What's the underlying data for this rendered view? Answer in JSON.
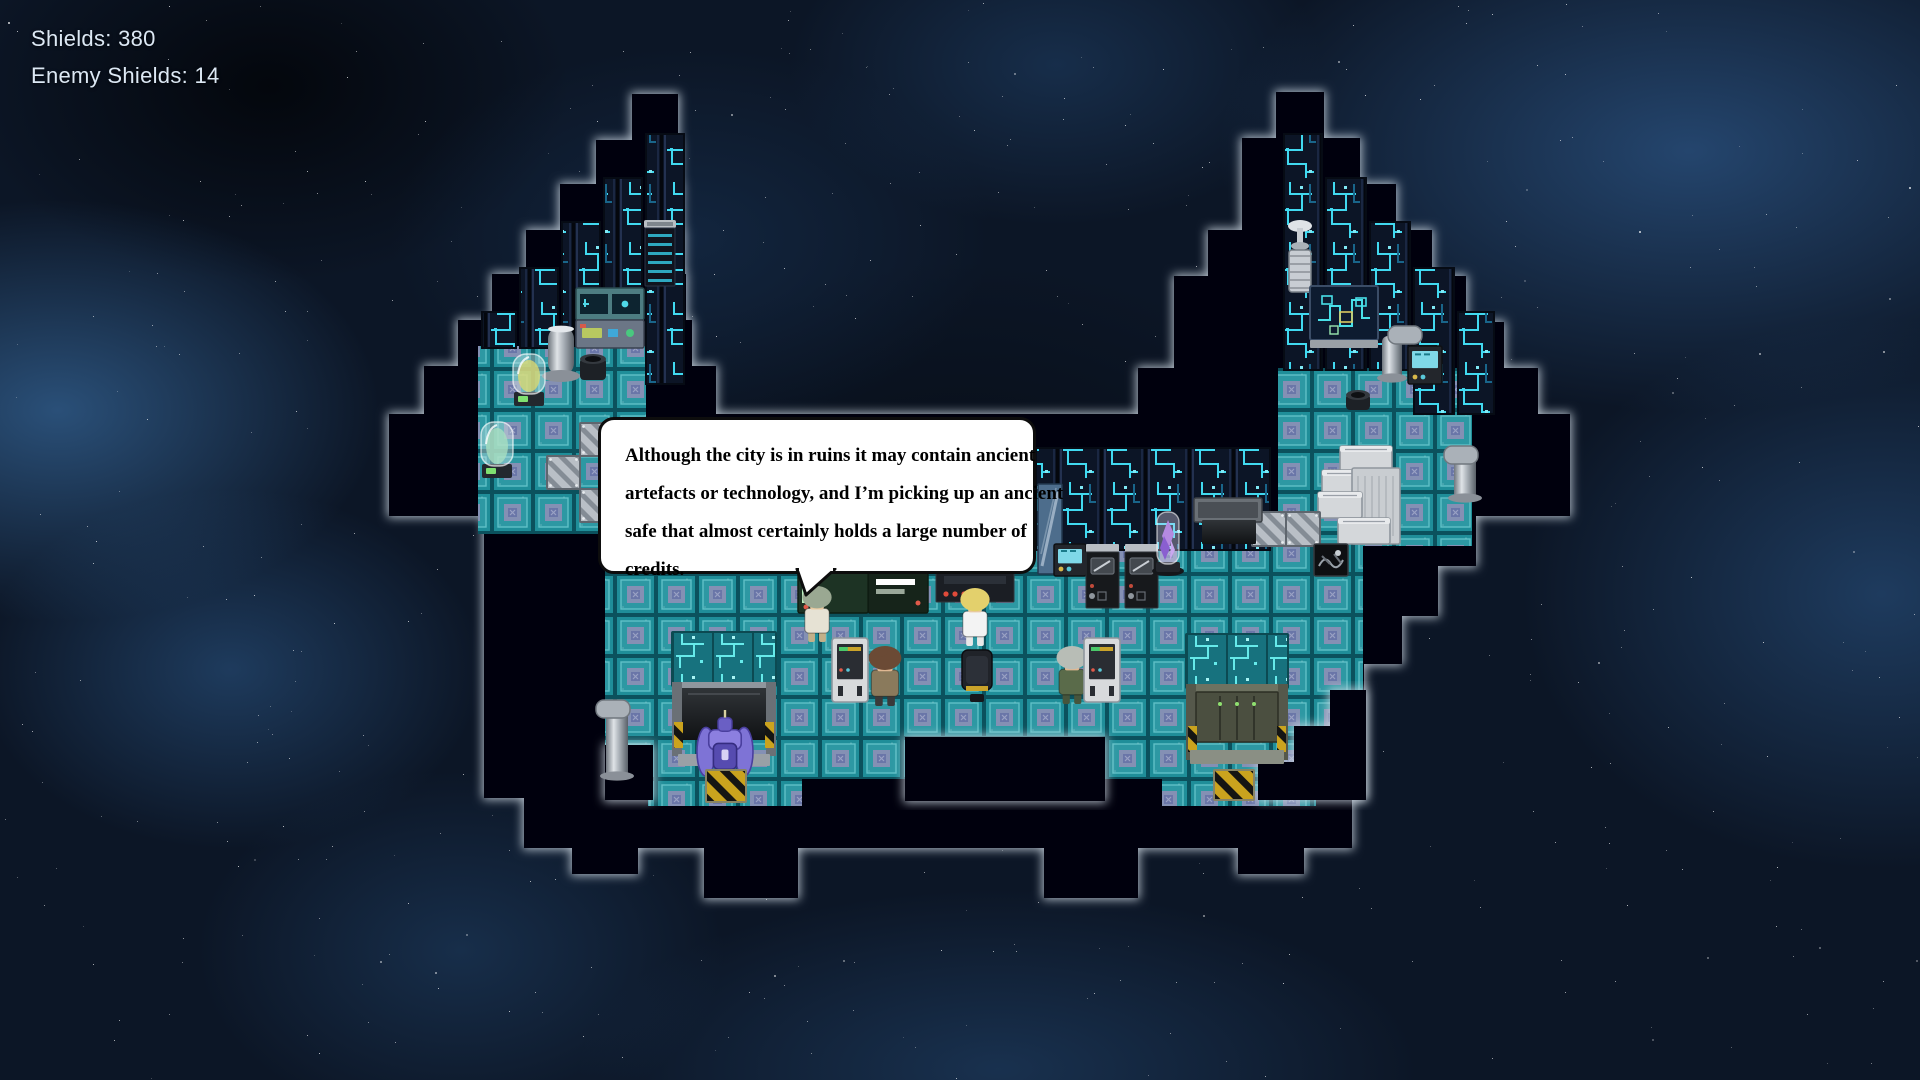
{
  "hud": {
    "shields": "Shields: 380",
    "enemy_shields": "Enemy Shields: 14"
  },
  "dialog": {
    "lines": [
      "Although the city is in ruins it may contain ancient",
      "artefacts or technology, and I’m picking up an ancient",
      "safe that almost certainly holds a large number of",
      "credits."
    ]
  },
  "palette": {
    "hud_text": "#dce8f4",
    "wall": "#040507",
    "wall_glow": "#cdd8e2",
    "floor_base": "#1f8e99",
    "floor_grid": "#0b515d",
    "floor_inner": "#2d98a3",
    "floor_emblem": "#8b90b5",
    "panel_bg": "#0c1526",
    "circuit_trace": "#41d9f0",
    "door_header": "#17727e",
    "hazard_yellow": "#caa31e",
    "silver": "#b9bfc6",
    "mech_purple": "#7e73d6"
  },
  "map": {
    "walls": [
      [
        632,
        94,
        46,
        48
      ],
      [
        596,
        140,
        84,
        46
      ],
      [
        560,
        184,
        122,
        48
      ],
      [
        526,
        230,
        158,
        46
      ],
      [
        492,
        274,
        194,
        48
      ],
      [
        458,
        320,
        234,
        48
      ],
      [
        424,
        366,
        292,
        50
      ],
      [
        1276,
        92,
        48,
        48
      ],
      [
        1242,
        138,
        118,
        48
      ],
      [
        1242,
        184,
        154,
        48
      ],
      [
        1208,
        230,
        224,
        48
      ],
      [
        1174,
        276,
        292,
        48
      ],
      [
        1174,
        322,
        330,
        46
      ],
      [
        1138,
        368,
        400,
        48
      ],
      [
        389,
        414,
        1181,
        102
      ],
      [
        484,
        514,
        880,
        284
      ],
      [
        1364,
        514,
        112,
        52
      ],
      [
        1364,
        566,
        74,
        50
      ],
      [
        1364,
        616,
        38,
        48
      ],
      [
        524,
        798,
        828,
        50
      ],
      [
        572,
        848,
        66,
        26
      ],
      [
        704,
        848,
        94,
        50
      ],
      [
        1044,
        848,
        94,
        50
      ],
      [
        1238,
        848,
        66,
        26
      ]
    ],
    "over_walls": [
      [
        905,
        737,
        200,
        64
      ],
      [
        1330,
        690,
        36,
        110
      ],
      [
        1294,
        726,
        40,
        74
      ],
      [
        1258,
        762,
        42,
        38
      ],
      [
        605,
        745,
        48,
        55
      ]
    ],
    "floors": [
      [
        478,
        346,
        168,
        188
      ],
      [
        605,
        530,
        758,
        209
      ],
      [
        605,
        739,
        302,
        40
      ],
      [
        1103,
        739,
        260,
        40
      ],
      [
        648,
        772,
        154,
        34
      ],
      [
        1162,
        772,
        154,
        34
      ],
      [
        1278,
        368,
        194,
        178
      ]
    ],
    "panels": [
      [
        646,
        134,
        38,
        250
      ],
      [
        604,
        178,
        38,
        114
      ],
      [
        562,
        222,
        38,
        124
      ],
      [
        520,
        268,
        38,
        80
      ],
      [
        482,
        312,
        34,
        36
      ],
      [
        1284,
        134,
        38,
        236
      ],
      [
        1326,
        178,
        40,
        192
      ],
      [
        1370,
        222,
        40,
        148
      ],
      [
        1414,
        268,
        40,
        146
      ],
      [
        1458,
        312,
        36,
        102
      ],
      [
        1036,
        448,
        234,
        102
      ]
    ],
    "entities": [
      {
        "name": "server-rack",
        "kind": "serverRack",
        "x": 644,
        "y": 220,
        "w": 32,
        "h": 66
      },
      {
        "name": "console-screens",
        "kind": "consoleTeal",
        "x": 576,
        "y": 288,
        "w": 68,
        "h": 32
      },
      {
        "name": "console-buttons",
        "kind": "consoleBtns",
        "x": 576,
        "y": 320,
        "w": 68,
        "h": 28
      },
      {
        "name": "pipe-left-tower",
        "kind": "pipeV",
        "x": 548,
        "y": 326,
        "w": 26,
        "h": 58
      },
      {
        "name": "pot-left-tower",
        "kind": "pot",
        "x": 578,
        "y": 352,
        "w": 30,
        "h": 30
      },
      {
        "name": "yellow-stasis-capsule",
        "kind": "capsule",
        "x": 512,
        "y": 348,
        "w": 34,
        "h": 60,
        "color": "#d9d873"
      },
      {
        "name": "green-stasis-capsule",
        "kind": "capsule",
        "x": 480,
        "y": 416,
        "w": 34,
        "h": 64,
        "color": "#a9dfc0"
      },
      {
        "name": "grate-tile-1",
        "kind": "grate",
        "x": 580,
        "y": 423,
        "w": 33,
        "h": 33
      },
      {
        "name": "grate-tile-2",
        "kind": "grate",
        "x": 547,
        "y": 456,
        "w": 33,
        "h": 33
      },
      {
        "name": "grate-tile-3",
        "kind": "grate",
        "x": 580,
        "y": 489,
        "w": 33,
        "h": 33
      },
      {
        "name": "trophy-fountain",
        "kind": "trophy",
        "x": 1282,
        "y": 220,
        "w": 36,
        "h": 74
      },
      {
        "name": "city-circuit-display",
        "kind": "circuitBoard",
        "x": 1310,
        "y": 286,
        "w": 68,
        "h": 62
      },
      {
        "name": "pipe-right-tower",
        "kind": "pipeElbowR",
        "x": 1382,
        "y": 326,
        "w": 44,
        "h": 56
      },
      {
        "name": "machine-right-tower",
        "kind": "screenDev",
        "x": 1408,
        "y": 346,
        "w": 34,
        "h": 38
      },
      {
        "name": "pot-right-tower",
        "kind": "pot",
        "x": 1344,
        "y": 388,
        "w": 28,
        "h": 24
      },
      {
        "name": "pipe-right-arm",
        "kind": "pipeElbowL",
        "x": 1444,
        "y": 446,
        "w": 40,
        "h": 56
      },
      {
        "name": "crate-pile",
        "kind": "crates",
        "x": 1318,
        "y": 446,
        "w": 84,
        "h": 98
      },
      {
        "name": "grate-tile-4",
        "kind": "grate",
        "x": 1252,
        "y": 512,
        "w": 34,
        "h": 34
      },
      {
        "name": "grate-tile-5",
        "kind": "grate",
        "x": 1286,
        "y": 512,
        "w": 34,
        "h": 34
      },
      {
        "name": "junk-safe-box",
        "kind": "safeBox",
        "x": 1314,
        "y": 544,
        "w": 34,
        "h": 32
      },
      {
        "name": "window-panel",
        "kind": "windowPanel",
        "x": 1038,
        "y": 484,
        "w": 24,
        "h": 90
      },
      {
        "name": "screen-device",
        "kind": "screenDev",
        "x": 1054,
        "y": 544,
        "w": 32,
        "h": 32
      },
      {
        "name": "oven-machines",
        "kind": "ovens",
        "x": 1086,
        "y": 544,
        "w": 72,
        "h": 64
      },
      {
        "name": "purple-crystal-capsule",
        "kind": "purpleCapsule",
        "x": 1156,
        "y": 510,
        "w": 24,
        "h": 66
      },
      {
        "name": "door-lintel-left",
        "kind": "lintel",
        "x": 686,
        "y": 498,
        "w": 68,
        "h": 24
      },
      {
        "name": "door-lintel-right",
        "kind": "lintel",
        "x": 1194,
        "y": 498,
        "w": 68,
        "h": 24
      },
      {
        "name": "door-shaft-left",
        "kind": "shaft",
        "x": 694,
        "y": 520,
        "w": 54,
        "h": 24
      },
      {
        "name": "door-shaft-right",
        "kind": "shaft",
        "x": 1202,
        "y": 520,
        "w": 54,
        "h": 24
      },
      {
        "name": "speaker-console",
        "kind": "consoleGreen",
        "x": 798,
        "y": 571,
        "w": 130,
        "h": 42
      },
      {
        "name": "dark-console",
        "kind": "consoleDark",
        "x": 936,
        "y": 566,
        "w": 78,
        "h": 36
      },
      {
        "name": "npc-green-hair",
        "kind": "char",
        "x": 800,
        "y": 586,
        "w": 34,
        "h": 56,
        "hair": "#9aa892",
        "coat": "#e6e2d4",
        "pants": "#c2b089",
        "skin": "#e8c9a0"
      },
      {
        "name": "npc-blonde-scientist",
        "kind": "char",
        "x": 958,
        "y": 588,
        "w": 34,
        "h": 58,
        "hair": "#e3d06c",
        "coat": "#f3f3f3",
        "pants": "#e8e8e8",
        "skin": "#e8c9a0"
      },
      {
        "name": "npc-trenchcoat-man",
        "kind": "char",
        "x": 866,
        "y": 646,
        "w": 38,
        "h": 60,
        "hair": "#6b4a35",
        "coat": "#8a7a5c",
        "pants": "#3a3a3a",
        "skin": "#e0b892"
      },
      {
        "name": "npc-soldier",
        "kind": "char",
        "x": 1054,
        "y": 646,
        "w": 36,
        "h": 58,
        "hair": "#b8bdb6",
        "coat": "#5a6b4a",
        "pants": "#46553c",
        "skin": "#e0b892"
      },
      {
        "name": "cabinet-left",
        "kind": "cabinet",
        "x": 832,
        "y": 638,
        "w": 36,
        "h": 64
      },
      {
        "name": "cabinet-right",
        "kind": "cabinet",
        "x": 1084,
        "y": 638,
        "w": 36,
        "h": 64
      },
      {
        "name": "chair",
        "kind": "chair",
        "x": 958,
        "y": 650,
        "w": 38,
        "h": 54
      },
      {
        "name": "left-airlock-door",
        "kind": "doorL",
        "x": 672,
        "y": 632,
        "w": 104,
        "h": 140
      },
      {
        "name": "right-airlock-door",
        "kind": "doorR",
        "x": 1186,
        "y": 634,
        "w": 102,
        "h": 136
      },
      {
        "name": "mech-robot",
        "kind": "mech",
        "x": 696,
        "y": 710,
        "w": 58,
        "h": 76
      },
      {
        "name": "hazard-floor-left",
        "kind": "hazardTile",
        "x": 706,
        "y": 770,
        "w": 40,
        "h": 32
      },
      {
        "name": "hazard-floor-right",
        "kind": "hazardTile",
        "x": 1214,
        "y": 770,
        "w": 40,
        "h": 30
      },
      {
        "name": "pipe-hall-left",
        "kind": "pipeElbowL",
        "x": 596,
        "y": 700,
        "w": 44,
        "h": 80
      }
    ]
  }
}
